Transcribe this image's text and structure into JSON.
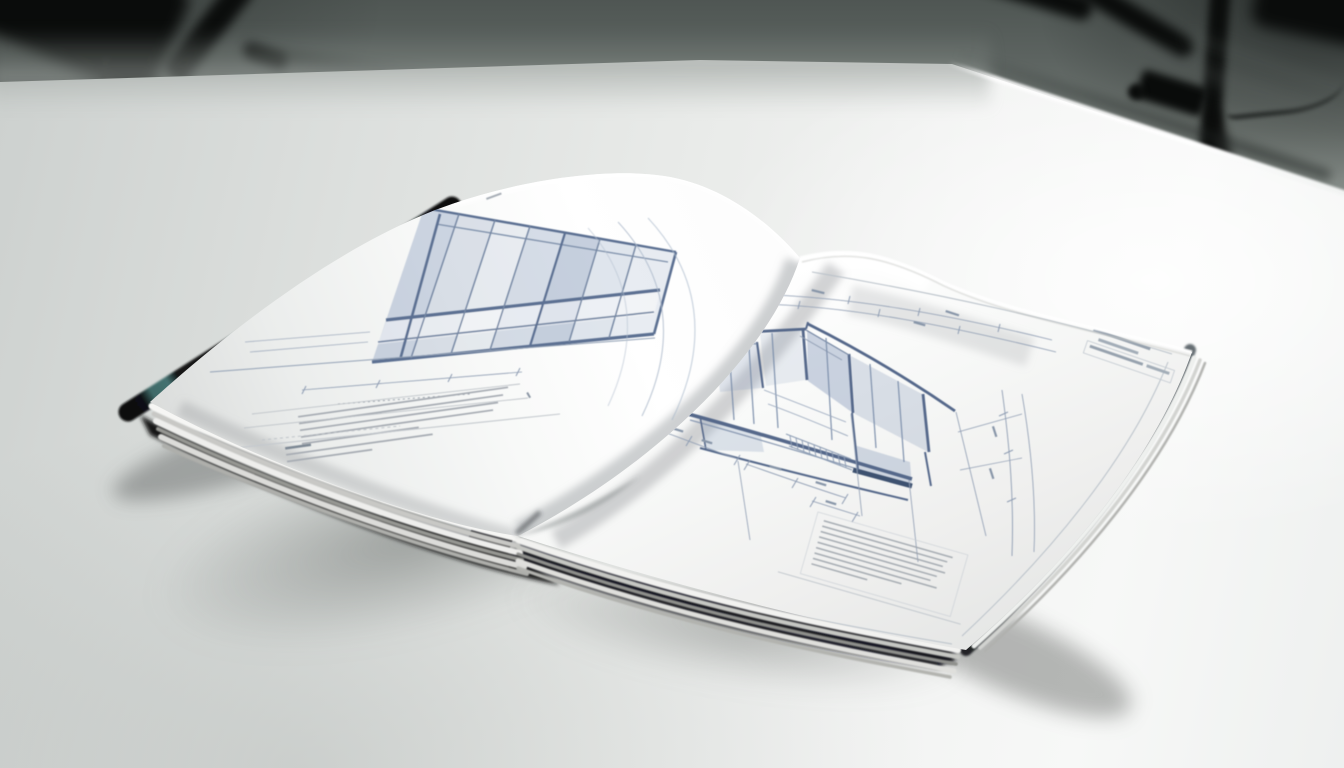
{
  "scene": {
    "kind": "studio product photograph",
    "description": "An open hardcover architecture book with blueprint-style elevation drawings lies on a bright white table in a gray photo studio; blurred black light-stand tripods stand in the background.",
    "background": {
      "label": "seamless gray studio backdrop",
      "wall_top": "#4f5653",
      "wall_bottom": "#b9bfbc"
    },
    "tripods": {
      "left": {
        "label": "blurred black tripod legs, out of focus, upper left"
      },
      "right": {
        "label": "blurred black light stand with clamp and trailing cable, out of focus, upper right"
      }
    },
    "table": {
      "label": "white studio table with bright back-right edge",
      "surface_bright": "#f8f9f8",
      "surface_shadow": "#ccd0ce",
      "edge_highlight": "#ffffff"
    },
    "book": {
      "label": "open hardcover book of architectural blueprint drawings",
      "cover_color": "#14171a",
      "cover_accent_teal": "#4e7a78",
      "cover_edge_gray": "#4a5156",
      "page_color": "#fafbfa",
      "ink_primary": "#5d7292",
      "ink_light": "#8ea0b8",
      "ink_fill": "rgba(141,158,184,0.4)",
      "annotation_gray": "#9aa1a9",
      "left_page": {
        "label": "left page with facade elevation",
        "drawing": "perspective elevation of a two-storey glazed facade with shaded window panels and slanting roof lines",
        "annotations": "two blocks of small illegible print, rule lines, dotted row and a short dimension chain"
      },
      "right_page": {
        "label": "right page with sectional elevation",
        "drawing": "sectional elevation of a building with dimension chains, extension lines, hatched stair strip and a dark ground beam",
        "title_block": "small illegible title block at the top right corner",
        "annotations": "boxed block of nine ruled annotation lines near the bottom edge"
      },
      "details": {
        "spine": "black spine notch visible at the bottom fold",
        "page_edges": "fanned page edges along the lower fore-edge and right side"
      }
    },
    "lighting": {
      "label": "soft key light from upper right",
      "shadow": "diffuse book shadow cast to lower left"
    }
  }
}
